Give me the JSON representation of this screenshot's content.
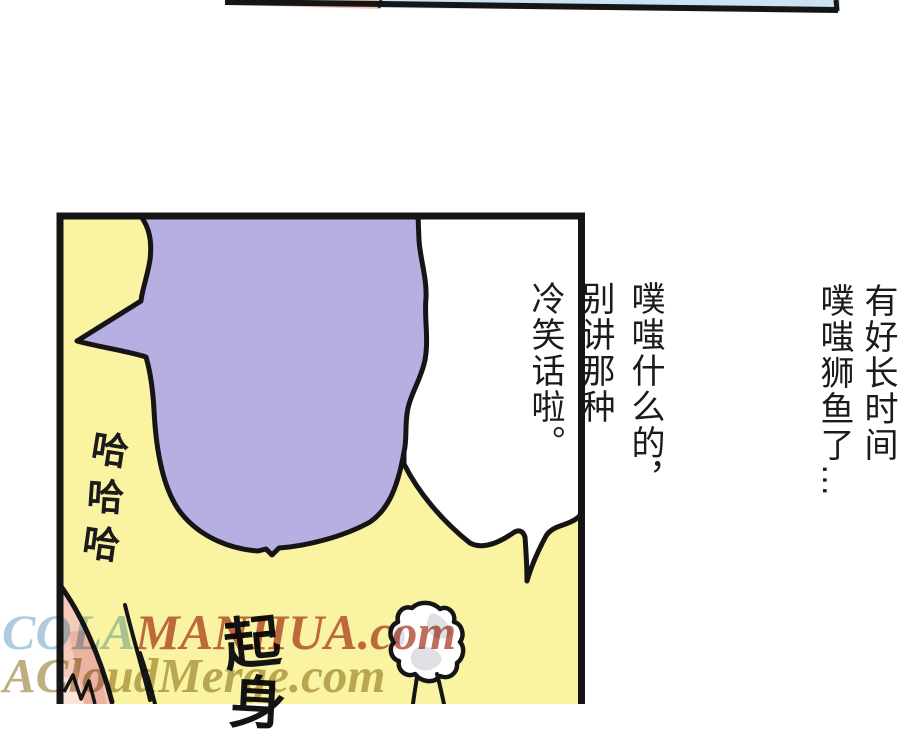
{
  "page": {
    "background": "#ffffff",
    "ink": "#151515"
  },
  "previous_panel": {
    "pink": "#f2c5b3",
    "blue": "#c9e3f5"
  },
  "panel": {
    "background": "#f9f3a2",
    "border_color": "#151515",
    "white_bubble": {
      "fill": "#ffffff",
      "lines": [
        "那就是说，",
        "有好长时间",
        "噗嗤狮鱼了…"
      ]
    },
    "purple_bubble": {
      "fill": "#b7aee2",
      "lines": [
        "噗嗤什么的，",
        "别讲那种",
        "冷笑话啦。"
      ]
    },
    "laugh_chars": [
      "哈",
      "哈",
      "哈"
    ],
    "sfx_chars": [
      "起",
      "身"
    ],
    "figure": {
      "skin": "#f4cbba",
      "skin_shadow": "#eab4a0",
      "skin_light": "#fbe4d8"
    },
    "cloud": {
      "fill": "#ffffff",
      "shade": "#dfe0e5"
    }
  },
  "watermarks": {
    "line1": [
      {
        "text": "COLA",
        "color": "#9fc3da"
      },
      {
        "text": "MANHUA.com",
        "color": "#b85441"
      }
    ],
    "line2": [
      {
        "text": "ACloudMerge.com",
        "color": "#b3a069"
      }
    ]
  }
}
